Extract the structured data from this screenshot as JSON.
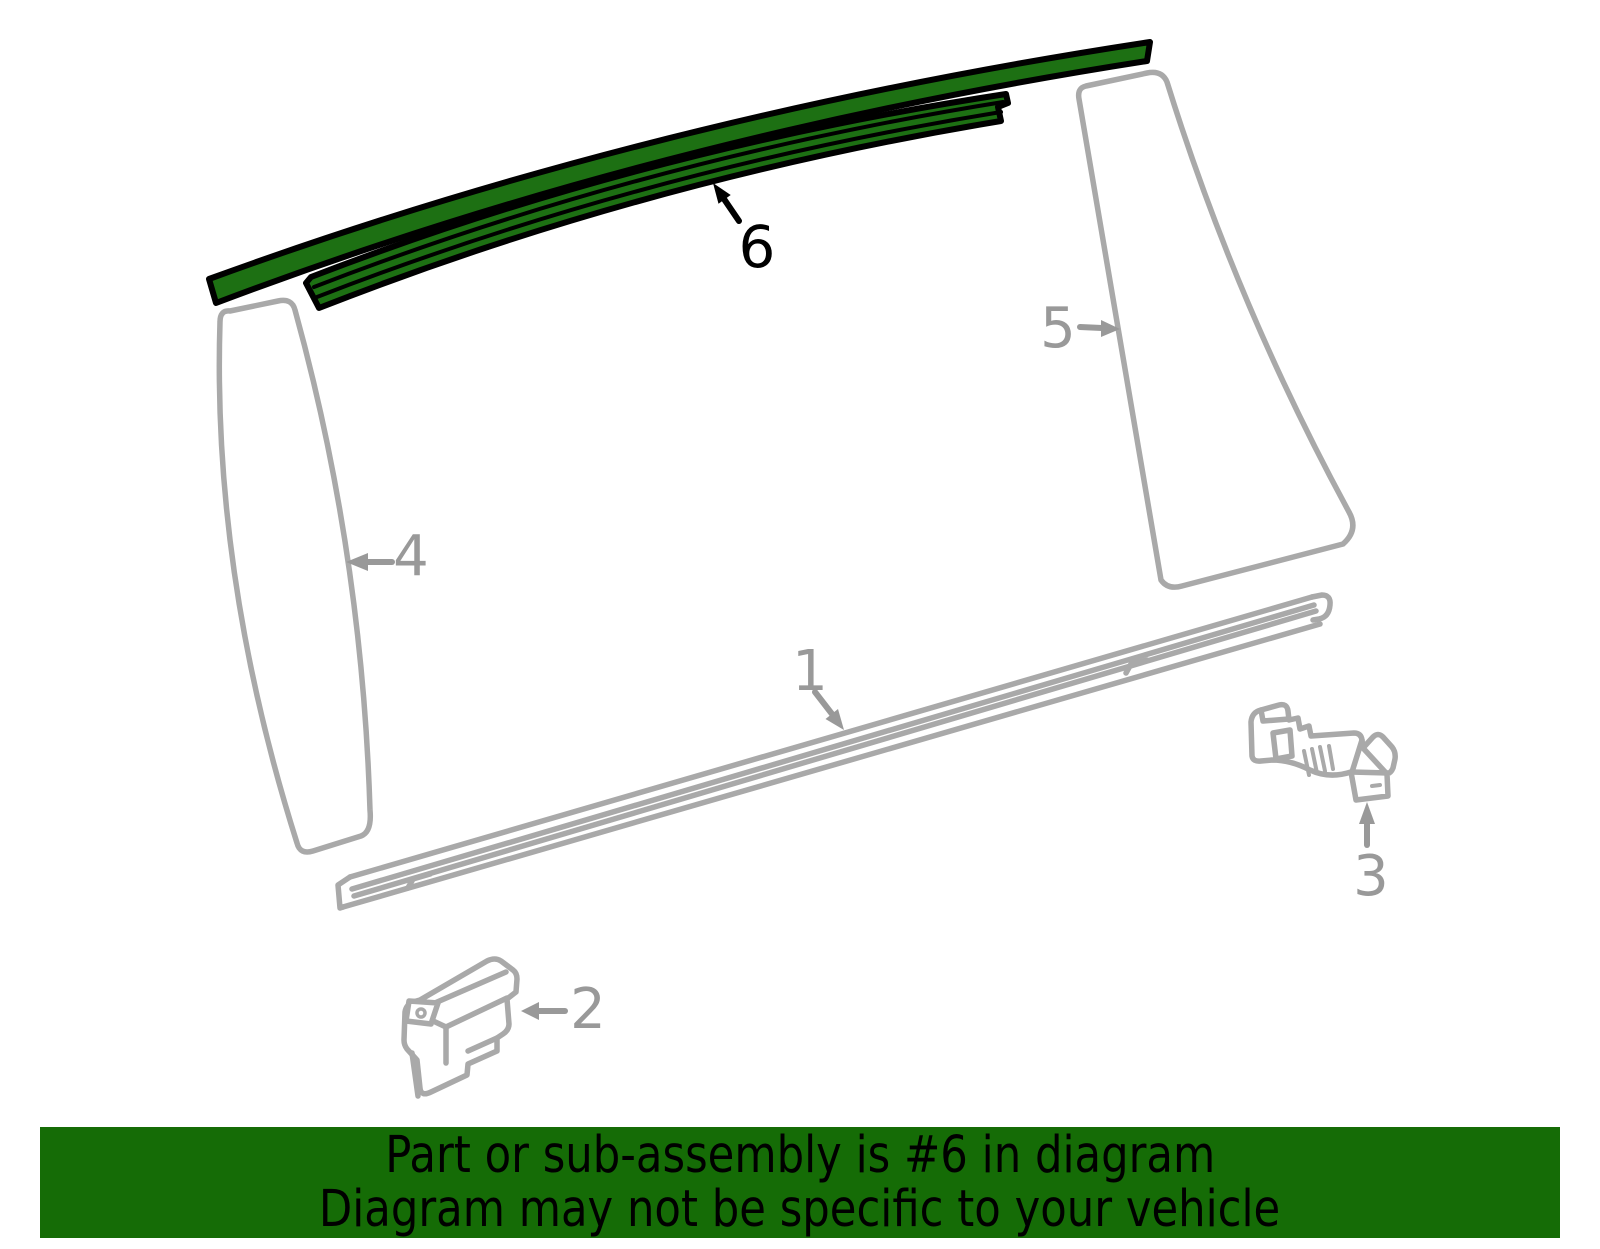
{
  "diagram": {
    "highlighted_part": "6",
    "highlight_color": "#1d7013",
    "line_color": "#a9a9a9",
    "label_color": "#999999",
    "outline_color": "#000000",
    "labels": {
      "p1": "1",
      "p2": "2",
      "p3": "3",
      "p4": "4",
      "p5": "5",
      "p6": "6"
    }
  },
  "banner": {
    "line1": "Part or sub-assembly is #6 in diagram",
    "line2": "Diagram may not be specific to your vehicle",
    "bg_color": "#156c06",
    "text_color": "#000000"
  }
}
